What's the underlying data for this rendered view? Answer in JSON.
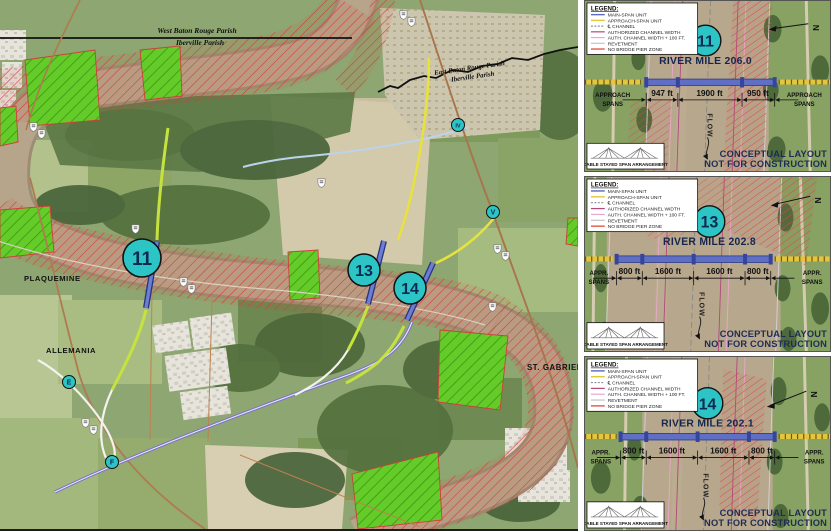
{
  "map": {
    "parish_boundary_west": {
      "line1": "West Baton Rouge Parish",
      "line2": "Iberville Parish"
    },
    "parish_boundary_east": {
      "line1": "East Baton Rouge Parish",
      "line2": "Iberville Parish"
    },
    "towns": {
      "plaquemine": "PLAQUEMINE",
      "allemania": "ALLEMANIA",
      "st_gabriel": "ST. GABRIEL"
    },
    "crossing_badges": [
      "11",
      "13",
      "14"
    ],
    "route_markers": [
      "E",
      "F",
      "IV",
      "V"
    ]
  },
  "legend": {
    "title": "LEGEND:",
    "items": [
      {
        "label": "MAIN-SPAN UNIT",
        "color": "#5a6abf"
      },
      {
        "label": "APPROACH-SPAN UNIT",
        "color": "#e0c93e"
      },
      {
        "label": "℄ CHANNEL",
        "color": "#8a9098"
      },
      {
        "label": "AUTHORIZED CHANNEL WIDTH",
        "color": "#b2487c"
      },
      {
        "label": "AUTH. CHANNEL WIDTH + 100 FT.",
        "color": "#eaa8c8"
      },
      {
        "label": "REVETMENT",
        "color": "#c4c4c4"
      },
      {
        "label": "NO BRIDGE PIER ZONE",
        "color": "#e05848"
      }
    ]
  },
  "panels": [
    {
      "badge": "11",
      "river_mile": "RIVER MILE 206.0",
      "spans": {
        "left1": "APPROACH",
        "left2": "SPANS",
        "right1": "APPROACH",
        "right2": "SPANS",
        "segments": [
          "947 ft",
          "1900 ft",
          "950 ft"
        ]
      },
      "flow_label": "FLOW",
      "north_label": "N",
      "cable_label": "CABLE STAYED SPAN ARRANGEMENT",
      "disclaimer1": "CONCEPTUAL LAYOUT",
      "disclaimer2": "NOT FOR CONSTRUCTION"
    },
    {
      "badge": "13",
      "river_mile": "RIVER MILE 202.8",
      "spans": {
        "left1": "APPR.",
        "left2": "SPANS",
        "right1": "APPR.",
        "right2": "SPANS",
        "segments": [
          "800 ft",
          "1600 ft",
          "1600 ft",
          "800 ft"
        ]
      },
      "flow_label": "FLOW",
      "north_label": "N",
      "cable_label": "CABLE STAYED SPAN ARRANGEMENT",
      "disclaimer1": "CONCEPTUAL LAYOUT",
      "disclaimer2": "NOT FOR CONSTRUCTION"
    },
    {
      "badge": "14",
      "river_mile": "RIVER MILE 202.1",
      "spans": {
        "left1": "APPR.",
        "left2": "SPANS",
        "right1": "APPR.",
        "right2": "SPANS",
        "segments": [
          "800 ft",
          "1600 ft",
          "1600 ft",
          "800 ft"
        ]
      },
      "flow_label": "FLOW",
      "north_label": "N",
      "cable_label": "CABLE STAYED SPAN ARRANGEMENT",
      "disclaimer1": "CONCEPTUAL LAYOUT",
      "disclaimer2": "NOT FOR CONSTRUCTION"
    }
  ],
  "colors": {
    "badge_fill": "#2cc4c4",
    "main_span": "#5f6fc5",
    "approach_span": "#e3c53e",
    "no_pier_zone": "#d23c3c",
    "river": "#b6a58a"
  }
}
